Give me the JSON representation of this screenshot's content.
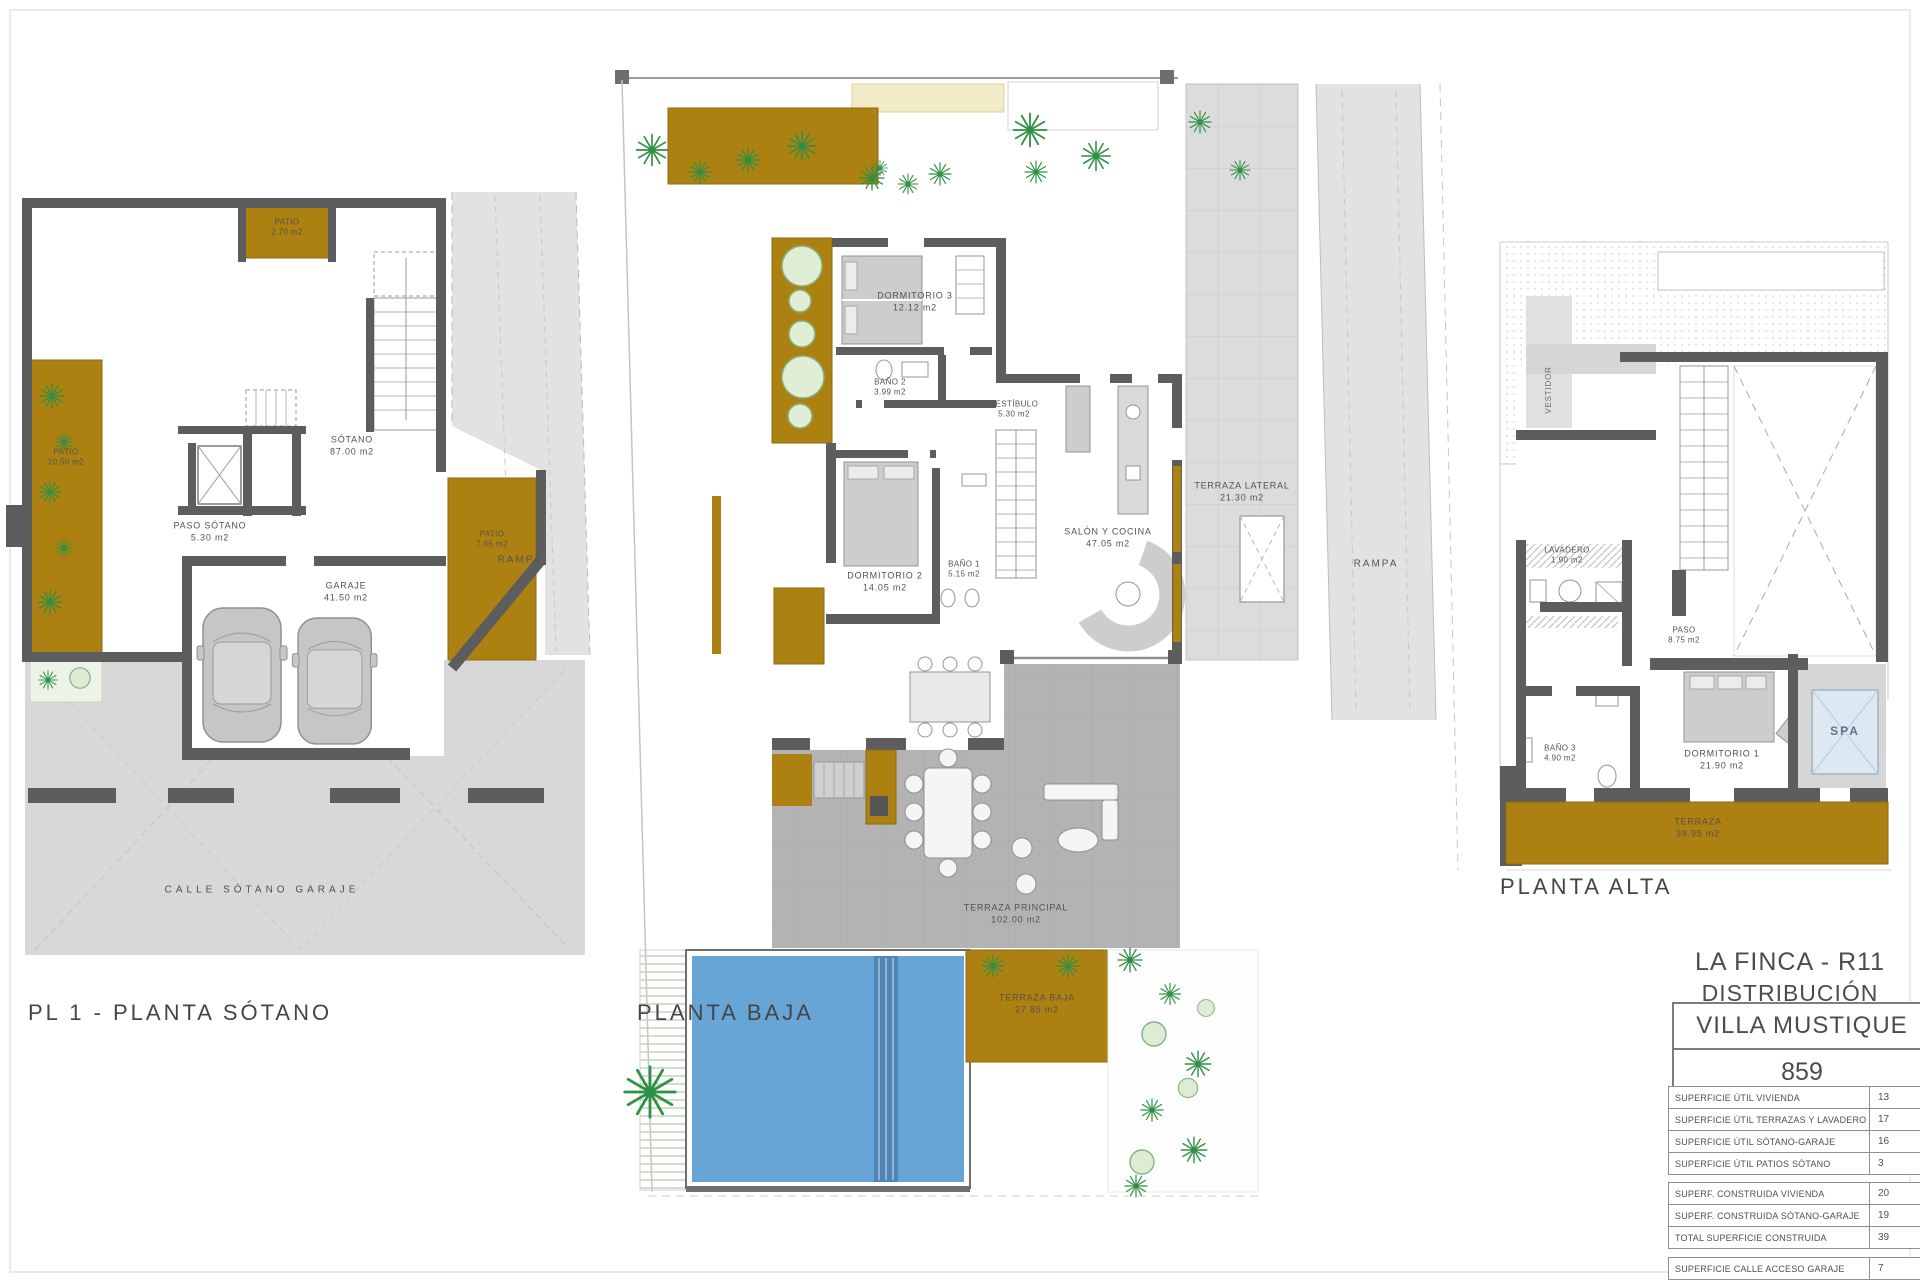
{
  "colors": {
    "gold": "#ac8112",
    "wall": "#5d5d5d",
    "pool": "#66a5d6",
    "spa": "#dce9f3",
    "street": "#d8d8d8",
    "terrace": "#b3b3b3",
    "plant": "#2e9143",
    "cream": "#f2ebc7"
  },
  "captions": {
    "sotano": "PL 1 - PLANTA SÓTANO",
    "baja": "PLANTA BAJA",
    "alta": "PLANTA ALTA"
  },
  "sotano": {
    "labels": {
      "patio_top": {
        "name": "PATIO",
        "area": "2.70 m2"
      },
      "sotano": {
        "name": "SÓTANO",
        "area": "87.00 m2"
      },
      "paso": {
        "name": "PASO SÓTANO",
        "area": "5.30 m2"
      },
      "patio_left": {
        "name": "PATIO",
        "area": "10.50 m2"
      },
      "patio_right": {
        "name": "PATIO",
        "area": "7.65 m2"
      },
      "garaje": {
        "name": "GARAJE",
        "area": "41.50 m2"
      },
      "rampa": "RAMPA",
      "calle": "CALLE SÓTANO GARAJE"
    }
  },
  "baja": {
    "labels": {
      "dormitorio3": {
        "name": "DORMITORIO 3",
        "area": "12.12 m2"
      },
      "bano2": {
        "name": "BAÑO 2",
        "area": "3.99 m2"
      },
      "vestibulo": {
        "name": "VESTÍBULO",
        "area": "5.30 m2"
      },
      "dormitorio2": {
        "name": "DORMITORIO 2",
        "area": "14.05 m2"
      },
      "bano1": {
        "name": "BAÑO 1",
        "area": "5.15 m2"
      },
      "salon": {
        "name": "SALÓN Y COCINA",
        "area": "47.05 m2"
      },
      "terraza_lateral": {
        "name": "TERRAZA LATERAL",
        "area": "21.30 m2"
      },
      "rampa": "RAMPA",
      "terraza_principal": {
        "name": "TERRAZA PRINCIPAL",
        "area": "102.00 m2"
      },
      "terraza_baja": {
        "name": "TERRAZA BAJA",
        "area": "27.85 m2"
      }
    }
  },
  "alta": {
    "labels": {
      "vestidor": "VESTIDOR",
      "lavadero": {
        "name": "LAVADERO",
        "area": "1.90 m2"
      },
      "paso": {
        "name": "PASO",
        "area": "8.75 m2"
      },
      "bano3": {
        "name": "BAÑO 3",
        "area": "4.90 m2"
      },
      "dormitorio1": {
        "name": "DORMITORIO 1",
        "area": "21.90 m2"
      },
      "spa": "SPA",
      "terraza": {
        "name": "TERRAZA",
        "area": "39.95 m2"
      }
    }
  },
  "title_block": {
    "project": "LA FINCA - R11",
    "subtitle": "DISTRIBUCIÓN",
    "villa_name": "VILLA MUSTIQUE",
    "plot_number": "859",
    "surface_util": [
      {
        "label": "SUPERFICIE ÚTIL VIVIENDA",
        "value": "13"
      },
      {
        "label": "SUPERFICIE ÚTIL TERRAZAS Y LAVADERO",
        "value": "17"
      },
      {
        "label": "SUPERFICIE ÚTIL SÓTANO-GARAJE",
        "value": "16"
      },
      {
        "label": "SUPERFICIE ÚTIL PATIOS SÓTANO",
        "value": "3"
      }
    ],
    "surface_construida": [
      {
        "label": "SUPERF. CONSTRUIDA VIVIENDA",
        "value": "20"
      },
      {
        "label": "SUPERF. CONSTRUIDA SÓTANO-GARAJE",
        "value": "19"
      },
      {
        "label": "TOTAL SUPERFICIE CONSTRUIDA",
        "value": "39"
      }
    ],
    "surface_calle": [
      {
        "label": "SUPERFICIE CALLE ACCESO GARAJE",
        "value": "7"
      }
    ]
  }
}
